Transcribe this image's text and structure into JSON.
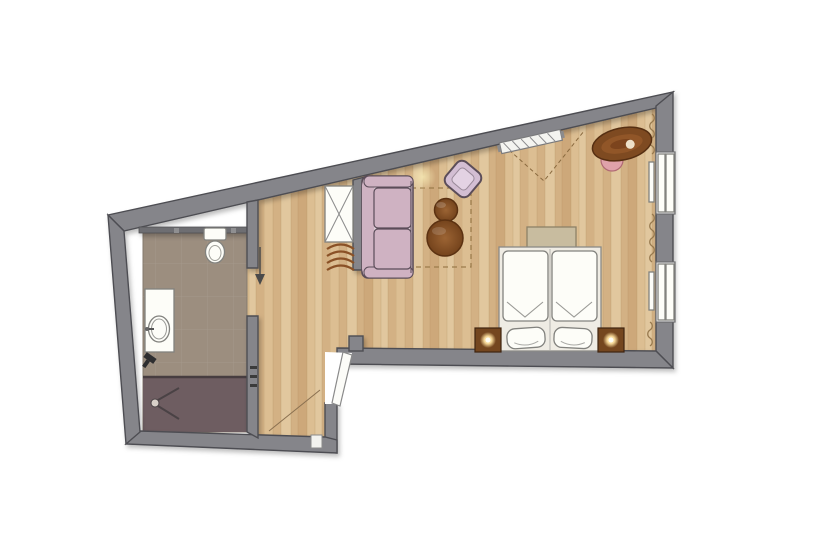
{
  "canvas": {
    "width": 820,
    "height": 560,
    "background": "#ffffff"
  },
  "palette": {
    "wall": "#85858a",
    "wall_outline": "#4e4e52",
    "wall_inner": "#6e6e72",
    "wood1": "#dcbe92",
    "wood2": "#d3b184",
    "wood3": "#e1c79e",
    "wood4": "#cda87a",
    "wood_seam": "#b2905f",
    "bath_floor": "#9c8e7f",
    "shower_floor": "#6e5d61",
    "shower_line": "#473d40",
    "fixture": "#fdfdf8",
    "fixture_stroke": "#82827e",
    "sofa": "#cfb2c2",
    "cushion": "#dfcdd8",
    "sofa_stroke": "#5b4d59",
    "armchair": "#d3bed3",
    "armchair_inner": "#e3d2e3",
    "table": "#8a5126",
    "table_stroke": "#5b3111",
    "desk": "#7e4a21",
    "chair": "#e0a2aa",
    "bench": "#c8bc9f",
    "bench_stroke": "#8d8167",
    "nightstand": "#74461f",
    "lamp": "#ffe2a0",
    "curtain": "#97794e",
    "rug": "#9b7b4b",
    "dash": "#8a6a3f",
    "swing": "#8a7050",
    "arrow": "#4a4a4a",
    "hook": "#3b3b3b",
    "dark_item": "#2e2e30"
  },
  "plan": {
    "type": "apartment-floor-plan",
    "rooms": [
      "bathroom",
      "entry-corridor",
      "living-sleeping-room"
    ],
    "window_count": 2,
    "coffee_table_count": 2,
    "nightstand_count": 2,
    "bed_type": "double",
    "elements": [
      "outer-walls",
      "wardrobe",
      "luggage-rack",
      "sofa",
      "armchair",
      "coffee-tables",
      "rug-outline",
      "radiator",
      "ceiling-lights",
      "desk",
      "desk-chair",
      "double-bed",
      "pillows",
      "foot-bench",
      "nightstands",
      "bedside-lamps",
      "window-top",
      "window-bottom",
      "curtains",
      "entry-door",
      "door-swing",
      "entrance-arrow",
      "coat-hooks",
      "toilet",
      "washbasin-vanity",
      "shower",
      "bathroom-doorway"
    ]
  }
}
